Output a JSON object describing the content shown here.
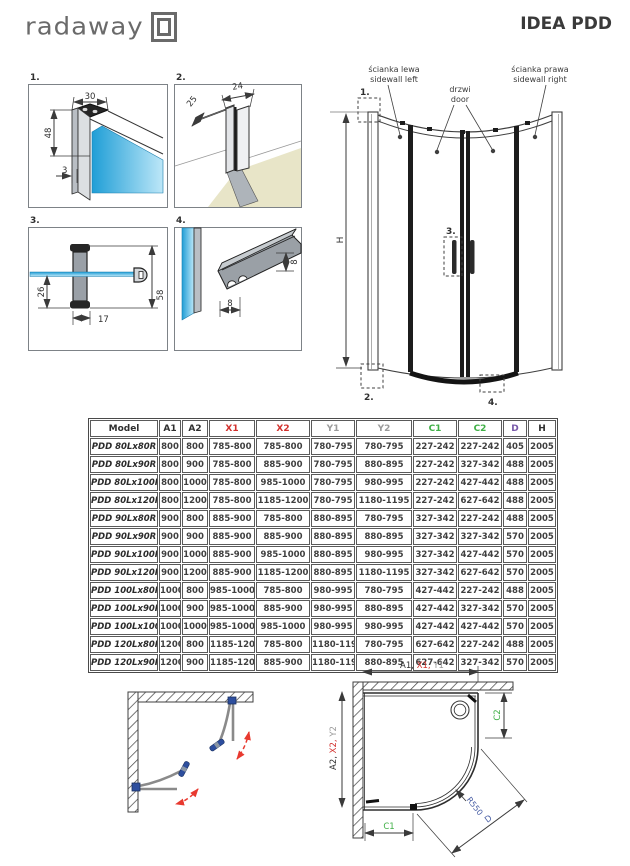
{
  "header": {
    "logo_text": "radaway",
    "title": "IDEA PDD"
  },
  "details": {
    "d1": {
      "label": "1.",
      "dim_top_width": "30",
      "dim_height": "48",
      "dim_glass_offset": "3"
    },
    "d2": {
      "label": "2.",
      "dim_depth": "25",
      "dim_width": "24"
    },
    "d3": {
      "label": "3.",
      "dim_below_glass": "26",
      "dim_handle_width": "17",
      "dim_handle_height": "58"
    },
    "d4": {
      "label": "4.",
      "dim_profile_height": "8",
      "dim_profile_width": "8"
    }
  },
  "front_view": {
    "sidewall_left_pl": "ścianka lewa",
    "sidewall_left_en": "sidewall left",
    "door_pl": "drzwi",
    "door_en": "door",
    "sidewall_right_pl": "ścianka prawa",
    "sidewall_right_en": "sidewall right",
    "height_label": "H",
    "marker_1": "1.",
    "marker_2": "2.",
    "marker_3": "3.",
    "marker_4": "4."
  },
  "table": {
    "headers": [
      "Model",
      "A1",
      "A2",
      "X1",
      "X2",
      "Y1",
      "Y2",
      "C1",
      "C2",
      "D",
      "H"
    ],
    "header_colors": [
      "black",
      "black",
      "black",
      "red",
      "red",
      "gray",
      "gray",
      "green",
      "green",
      "purple",
      "black"
    ],
    "rows": [
      [
        "PDD 80Lx80R",
        "800",
        "800",
        "785-800",
        "785-800",
        "780-795",
        "780-795",
        "227-242",
        "227-242",
        "405",
        "2005"
      ],
      [
        "PDD 80Lx90R",
        "800",
        "900",
        "785-800",
        "885-900",
        "780-795",
        "880-895",
        "227-242",
        "327-342",
        "488",
        "2005"
      ],
      [
        "PDD 80Lx100R",
        "800",
        "1000",
        "785-800",
        "985-1000",
        "780-795",
        "980-995",
        "227-242",
        "427-442",
        "488",
        "2005"
      ],
      [
        "PDD 80Lx120R",
        "800",
        "1200",
        "785-800",
        "1185-1200",
        "780-795",
        "1180-1195",
        "227-242",
        "627-642",
        "488",
        "2005"
      ],
      [
        "PDD 90Lx80R",
        "900",
        "800",
        "885-900",
        "785-800",
        "880-895",
        "780-795",
        "327-342",
        "227-242",
        "488",
        "2005"
      ],
      [
        "PDD 90Lx90R",
        "900",
        "900",
        "885-900",
        "885-900",
        "880-895",
        "880-895",
        "327-342",
        "327-342",
        "570",
        "2005"
      ],
      [
        "PDD 90Lx100R",
        "900",
        "1000",
        "885-900",
        "985-1000",
        "880-895",
        "980-995",
        "327-342",
        "427-442",
        "570",
        "2005"
      ],
      [
        "PDD 90Lx120R",
        "900",
        "1200",
        "885-900",
        "1185-1200",
        "880-895",
        "1180-1195",
        "327-342",
        "627-642",
        "570",
        "2005"
      ],
      [
        "PDD 100Lx80R",
        "1000",
        "800",
        "985-1000",
        "785-800",
        "980-995",
        "780-795",
        "427-442",
        "227-242",
        "488",
        "2005"
      ],
      [
        "PDD 100Lx90R",
        "1000",
        "900",
        "985-1000",
        "885-900",
        "980-995",
        "880-895",
        "427-442",
        "327-342",
        "570",
        "2005"
      ],
      [
        "PDD 100Lx100R",
        "1000",
        "1000",
        "985-1000",
        "985-1000",
        "980-995",
        "980-995",
        "427-442",
        "427-442",
        "570",
        "2005"
      ],
      [
        "PDD 120Lx80R",
        "1200",
        "800",
        "1185-1200",
        "785-800",
        "1180-1195",
        "780-795",
        "627-642",
        "227-242",
        "488",
        "2005"
      ],
      [
        "PDD 120Lx90R",
        "1200",
        "900",
        "1185-1200",
        "885-900",
        "1180-1195",
        "880-895",
        "627-642",
        "327-342",
        "570",
        "2005"
      ]
    ]
  },
  "plan_view": {
    "dim_top_a": "A1, ",
    "dim_top_x": "X1, ",
    "dim_top_y": "Y1",
    "dim_left_a": "A2, ",
    "dim_left_x": "X2, ",
    "dim_left_y": "Y2",
    "dim_c1": "C1",
    "dim_c2": "C2",
    "radius_label": "R550",
    "diagonal_label": "D"
  },
  "colors": {
    "accent_red": "#d2312d",
    "dim_gray": "#9b9b9b",
    "dim_green": "#3faf46",
    "dim_purple": "#7757a8",
    "dim_blue": "#4a5fa5",
    "glass_blue": "#2fa8dd"
  }
}
